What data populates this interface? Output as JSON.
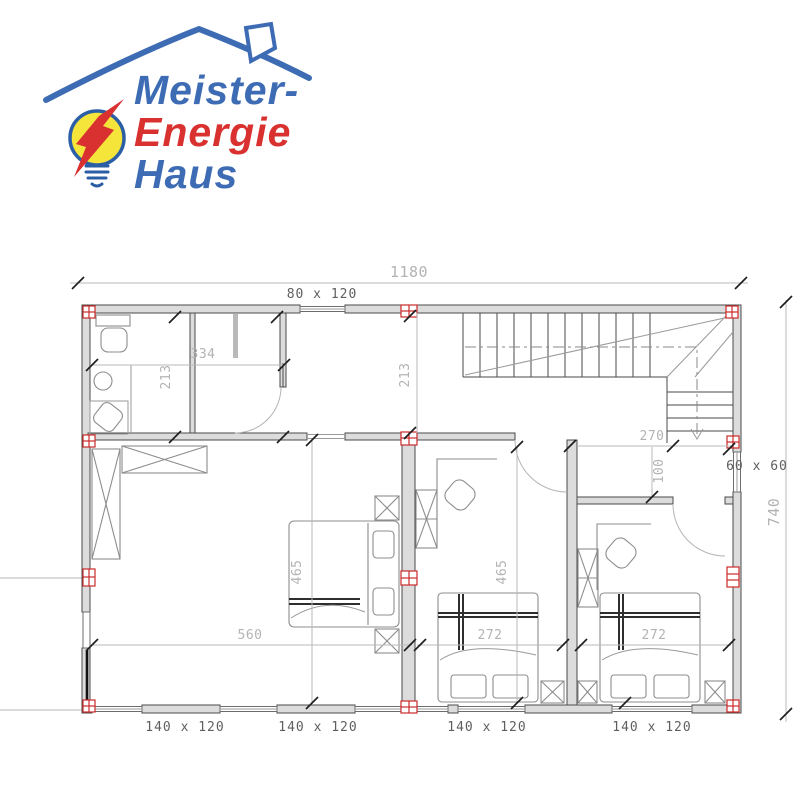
{
  "logo": {
    "word1": "Meister-",
    "word2": "Energie",
    "word3": "Haus"
  },
  "floor_plan": {
    "overall": {
      "width": "1180",
      "height": "740"
    },
    "windows": {
      "top": "80 x 120",
      "right": "60 x 60",
      "bottom": [
        "140 x 120",
        "140 x 120",
        "140 x 120",
        "140 x 120"
      ]
    },
    "rooms": {
      "bathroom": {
        "width": "334",
        "depth": "213"
      },
      "hall_top": {
        "depth": "213"
      },
      "stair_hall": {
        "width": "270",
        "corridor_depth": "100"
      },
      "living": {
        "width": "560",
        "depth": "465"
      },
      "child_room_1": {
        "width": "272",
        "depth": "465"
      },
      "child_room_2": {
        "width": "272"
      }
    }
  },
  "colors": {
    "logo_blue": "#3d6cb4",
    "logo_red": "#d93030",
    "bulb_yellow": "#f5e53a",
    "bulb_outline": "#2c5ea6",
    "marker_red": "#cc2a2a",
    "dim_gray": "#b3b3b3",
    "wall_line": "#4a4a4a",
    "wall_fill": "#dcdcdc"
  }
}
